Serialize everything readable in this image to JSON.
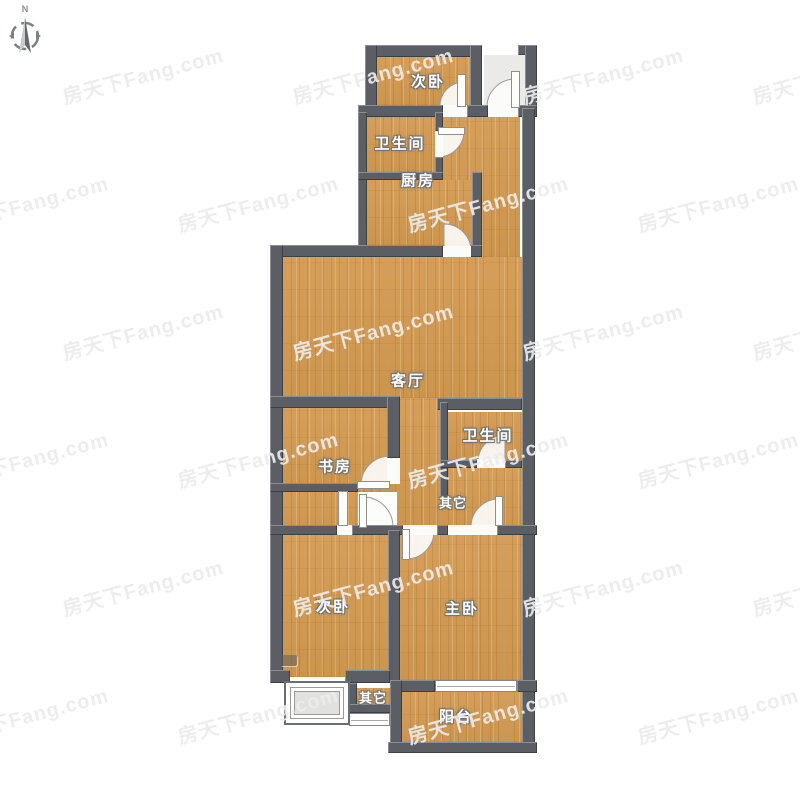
{
  "compass": {
    "label": "N"
  },
  "watermark": {
    "text": "房天下Fang.com"
  },
  "rooms": {
    "bedroom_top": "次卧",
    "bathroom_top": "卫生间",
    "kitchen": "厨房",
    "living_room": "客厅",
    "study": "书房",
    "bathroom_mid": "卫生间",
    "other_mid": "其它",
    "bedroom_left": "次卧",
    "master_bedroom": "主卧",
    "other_bottom": "其它",
    "balcony": "阳台"
  },
  "colors": {
    "wall": "#5b5e64",
    "floor_wood": "#d09b56",
    "label_text": "#ffffff",
    "watermark": "#ececec",
    "background": "#ffffff",
    "door_swing_fill": "#fcfcfa"
  }
}
